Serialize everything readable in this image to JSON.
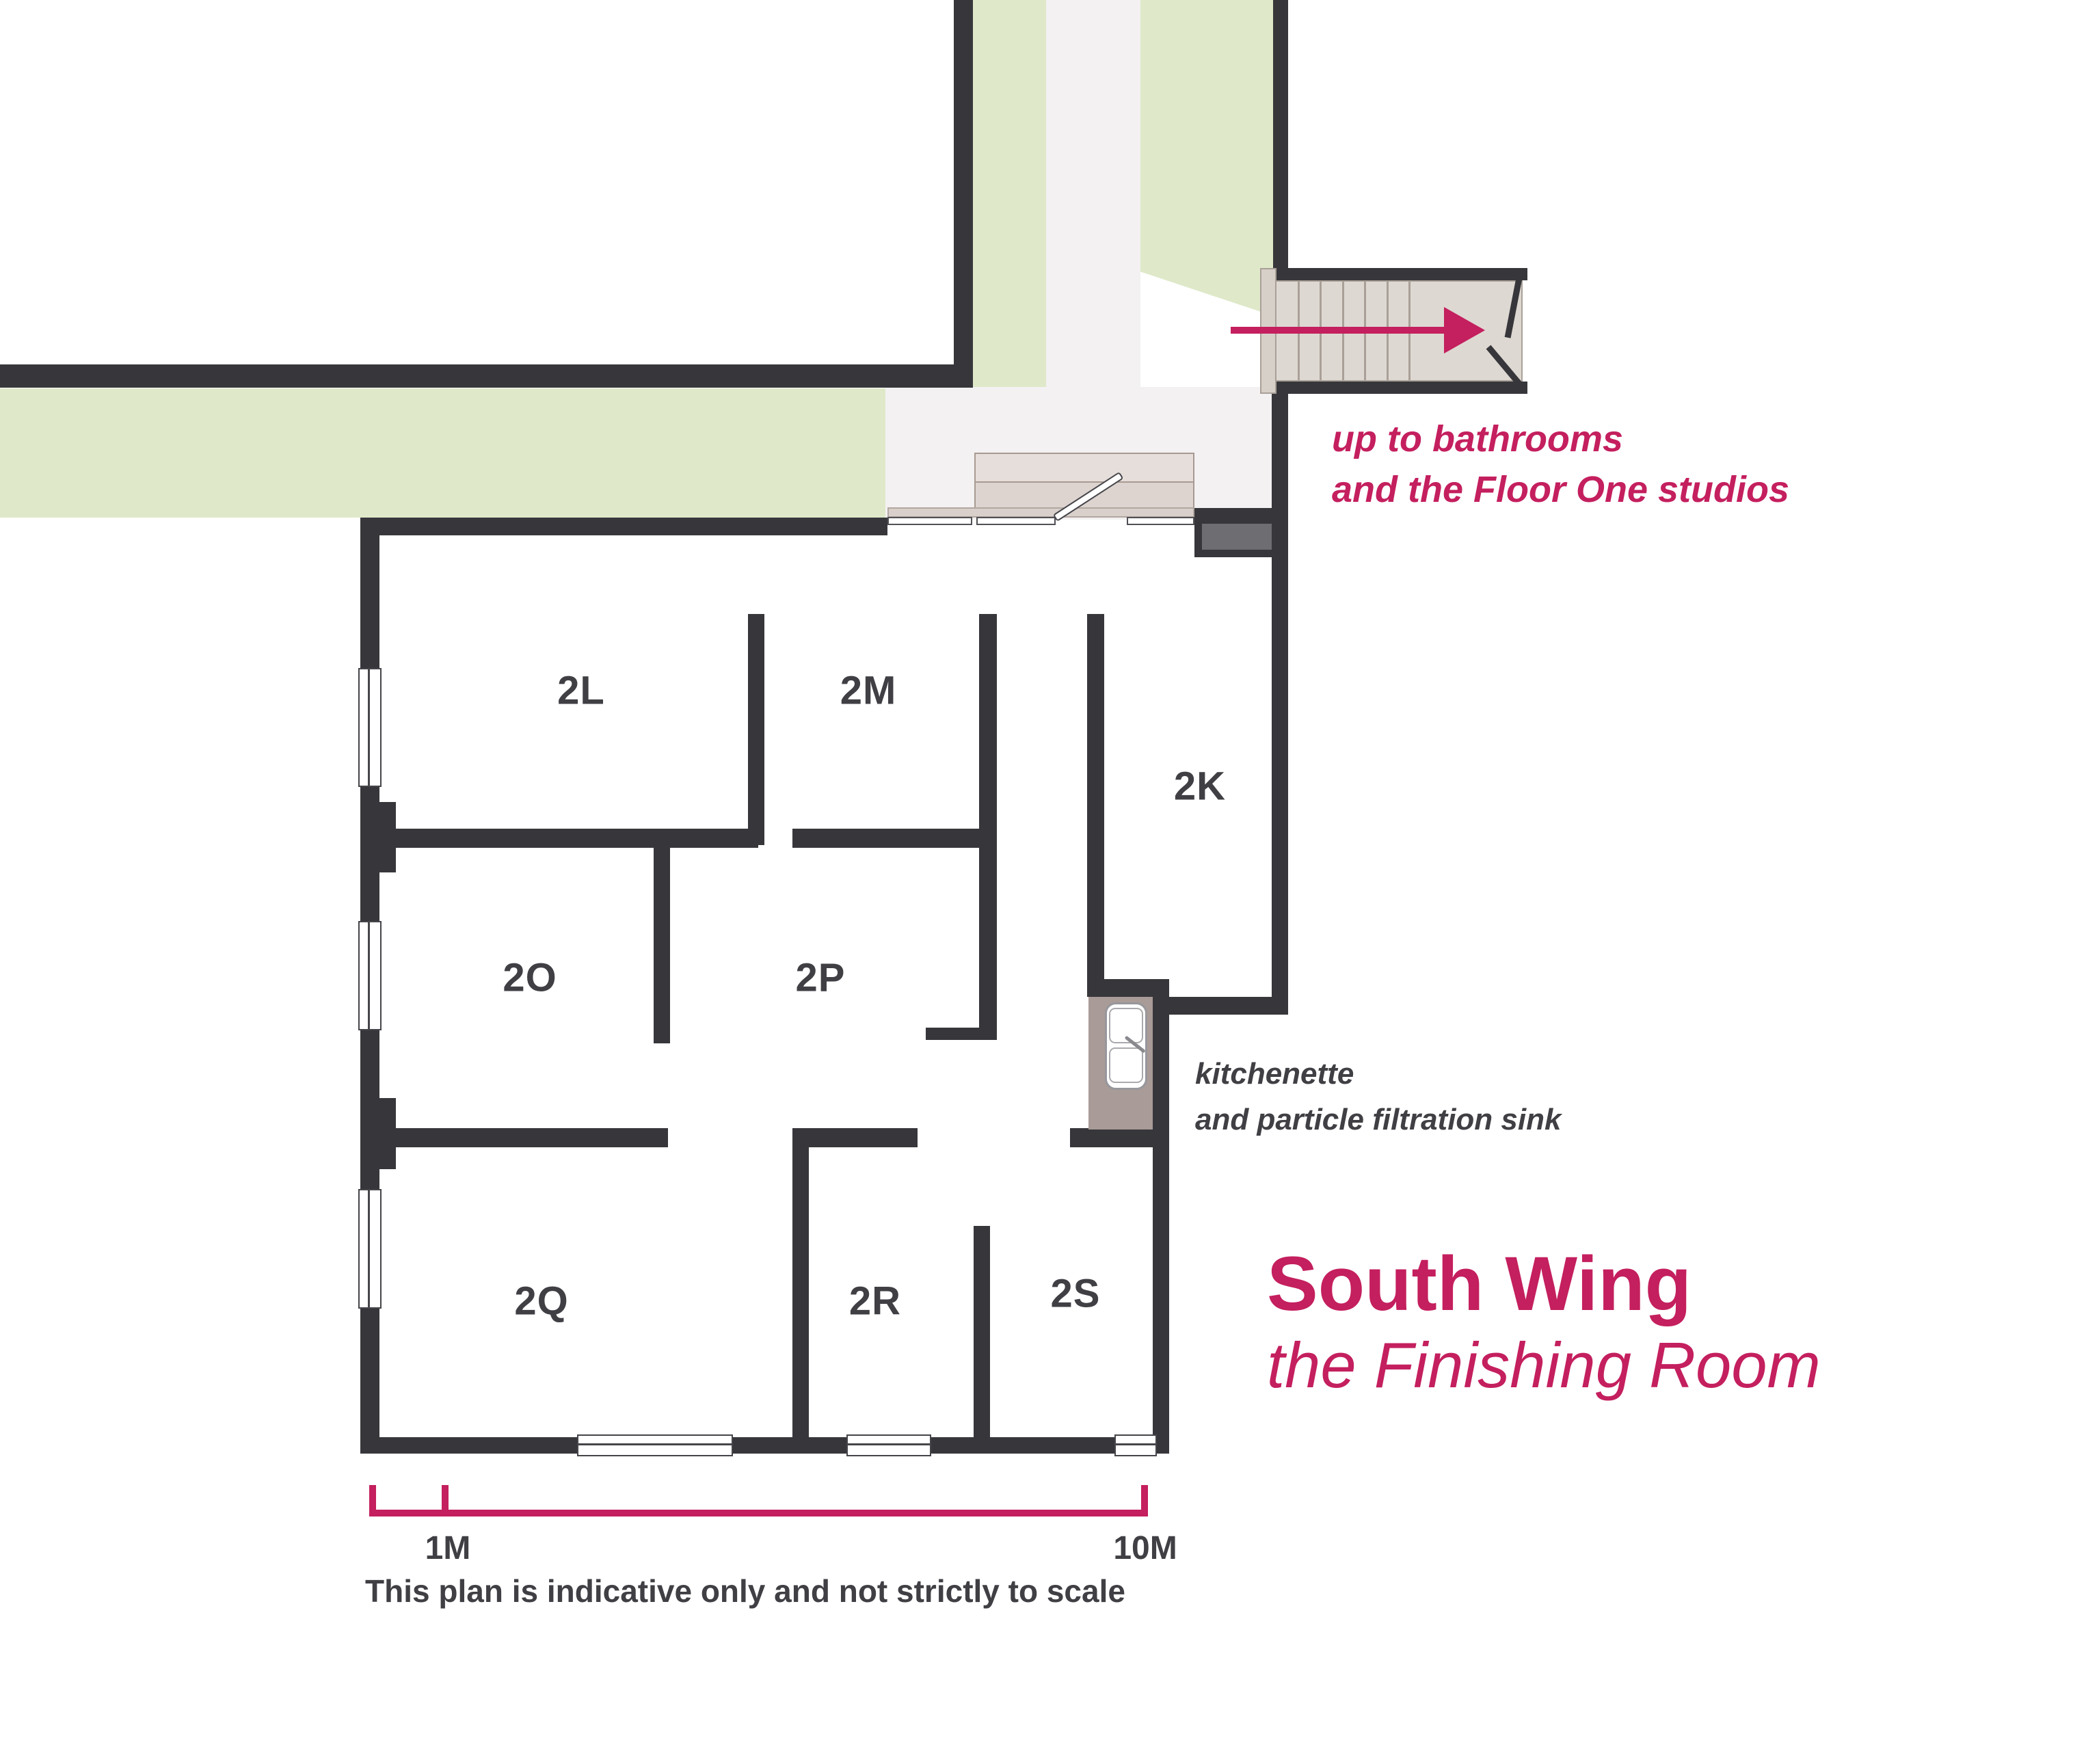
{
  "plan": {
    "title": "South Wing",
    "subtitle": "the Finishing Room",
    "rooms": [
      {
        "label": "2L"
      },
      {
        "label": "2M"
      },
      {
        "label": "2K"
      },
      {
        "label": "2O"
      },
      {
        "label": "2P"
      },
      {
        "label": "2Q"
      },
      {
        "label": "2R"
      },
      {
        "label": "2S"
      }
    ],
    "stair_note": {
      "line1": "up to bathrooms",
      "line2": "and the Floor One studios"
    },
    "kitchenette_note": {
      "line1": "kitchenette",
      "line2": "and particle filtration sink"
    },
    "scale_bar": {
      "start_label": "1M",
      "end_label": "10M"
    },
    "disclaimer": "This plan is indicative only and not strictly to scale",
    "icons": {
      "direction_arrow": "direction-arrow-icon",
      "sink": "sink-icon",
      "door_leaf": "door-leaf-icon",
      "stair_break": "stair-break-icon",
      "window": "window-symbol"
    },
    "colors": {
      "accent": "#c41f5e",
      "wall": "#37373b",
      "landscaping_green": "#dfe9c9",
      "hall_floor": "#f3f1f2",
      "stair_tread": "#ded8d2",
      "kitchenette_counter": "#a99b97",
      "duct_gray": "#6d6d72",
      "ink": "#3f3f44"
    }
  }
}
